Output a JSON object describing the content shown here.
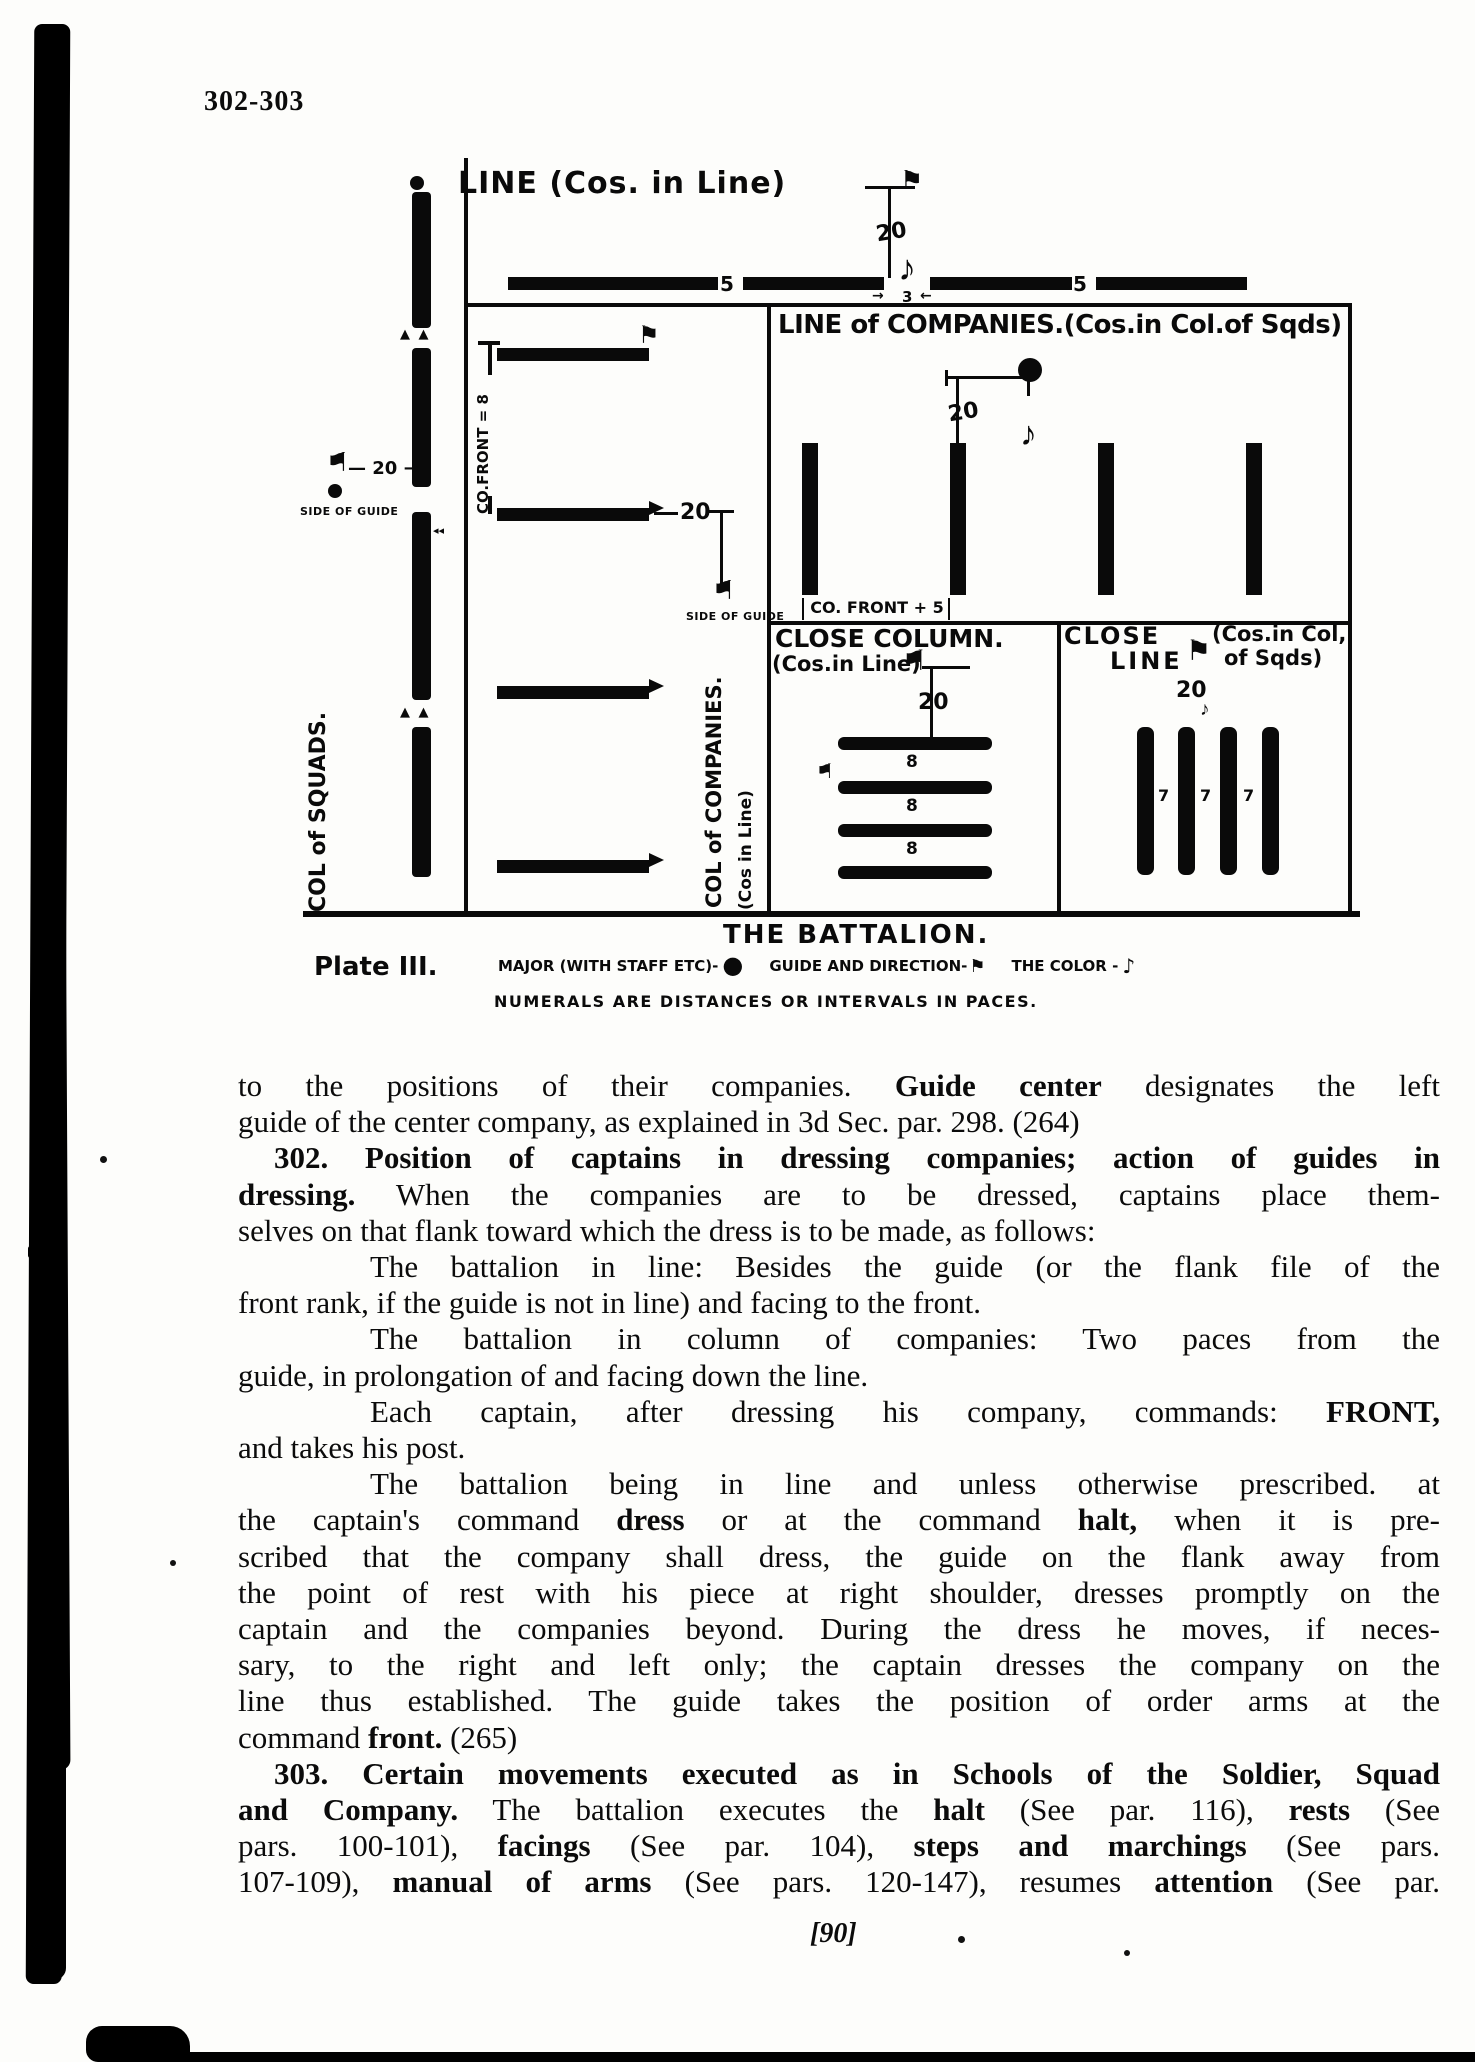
{
  "page": {
    "folio": "302-303",
    "page_number": "[90]"
  },
  "diagram": {
    "caption": "THE BATTALION.",
    "plate": "Plate III.",
    "top": {
      "title": "LINE (Cos. in Line)",
      "dist20": "20",
      "five": "5",
      "color_gap": "3",
      "arrow_in_l": "→",
      "arrow_in_r": "←"
    },
    "line_of_cos": {
      "title": "LINE of COMPANIES.(Cos.in Col.of Sqds)",
      "dist20": "20",
      "co_front": "CO. FRONT + 5"
    },
    "close_column": {
      "title": "CLOSE COLUMN.",
      "subtitle": "(Cos.in Line)",
      "dist20": "20",
      "dist8": "8"
    },
    "close_line": {
      "title1": "CLOSE",
      "title2": "LINE",
      "subtitle1": "(Cos.in Col,",
      "subtitle2": "of Sqds)",
      "dist20": "20",
      "dist7": "7"
    },
    "col_of_cos": {
      "label": "COL of COMPANIES.",
      "sublabel": "(Cos in Line)",
      "dist20": "20",
      "dash": "—",
      "co_front": "CO.FRONT = 8",
      "side_of_guide": "SIDE OF GUIDE"
    },
    "col_of_squads": {
      "label": "COL of SQUADS.",
      "dist20": "— 20 →",
      "side_of_guide": "SIDE OF GUIDE",
      "break_marks": "▲ ▲",
      "guide_marks": "◂◂"
    },
    "legend": {
      "major": "MAJOR (WITH STAFF ETC)-",
      "major_icon": "●",
      "guide": "GUIDE AND DIRECTION-",
      "guide_icon": "⚑",
      "color": "THE COLOR -",
      "color_icon": "♪",
      "note": "NUMERALS ARE DISTANCES OR INTERVALS IN PACES."
    },
    "icons": {
      "flag": "⚑",
      "note": "♪"
    }
  },
  "body": {
    "lines": [
      {
        "i": 0,
        "j": 1,
        "t": "to the positions of their companies.  **Guide center** designates the left"
      },
      {
        "i": 0,
        "j": 0,
        "t": "guide of the center company, as explained in 3d Sec. par. 298.  (264)"
      },
      {
        "i": 1,
        "j": 1,
        "t": "**302.  Position of captains in dressing companies; action of guides in**"
      },
      {
        "i": 0,
        "j": 1,
        "t": "**dressing.**  When the companies are to be dressed, captains place them-"
      },
      {
        "i": 0,
        "j": 0,
        "t": "selves on that flank toward which the dress is to be made, as follows:"
      },
      {
        "i": 2,
        "j": 1,
        "t": "The battalion in line:  Besides the guide (or the flank file of the"
      },
      {
        "i": 0,
        "j": 0,
        "t": "front rank, if the guide is not in line) and facing to the front."
      },
      {
        "i": 2,
        "j": 1,
        "t": "The battalion in column of companies:  Two paces from the"
      },
      {
        "i": 0,
        "j": 0,
        "t": "guide, in prolongation of and facing down the line."
      },
      {
        "i": 2,
        "j": 1,
        "t": "Each captain, after dressing his company, commands: **FRONT,**"
      },
      {
        "i": 0,
        "j": 0,
        "t": "and takes his post."
      },
      {
        "i": 2,
        "j": 1,
        "t": "The battalion being in line and unless otherwise prescribed. at"
      },
      {
        "i": 0,
        "j": 1,
        "t": "the captain's command **dress** or at the command **halt,** when it is pre-"
      },
      {
        "i": 0,
        "j": 1,
        "t": "scribed that the company shall dress, the guide on the flank away from"
      },
      {
        "i": 0,
        "j": 1,
        "t": "the point of rest with his piece at right shoulder, dresses promptly on the"
      },
      {
        "i": 0,
        "j": 1,
        "t": "captain and the companies beyond.  During the dress he moves, if neces-"
      },
      {
        "i": 0,
        "j": 1,
        "t": "sary, to the right and left only; the captain dresses the company on the"
      },
      {
        "i": 0,
        "j": 1,
        "t": "line thus established.  The guide takes the position of order arms at the"
      },
      {
        "i": 0,
        "j": 0,
        "t": "command **front.**  (265)"
      },
      {
        "i": 1,
        "j": 1,
        "t": "**303.  Certain movements executed as in Schools of the Soldier, Squad**"
      },
      {
        "i": 0,
        "j": 1,
        "t": "**and Company.**  The battalion executes the **halt** (See par. 116), **rests** (See"
      },
      {
        "i": 0,
        "j": 1,
        "t": "pars. 100-101), **facings** (See par. 104), **steps and marchings** (See pars."
      },
      {
        "i": 0,
        "j": 1,
        "t": "107-109), **manual of arms** (See pars. 120-147), resumes **attention** (See par."
      }
    ]
  }
}
